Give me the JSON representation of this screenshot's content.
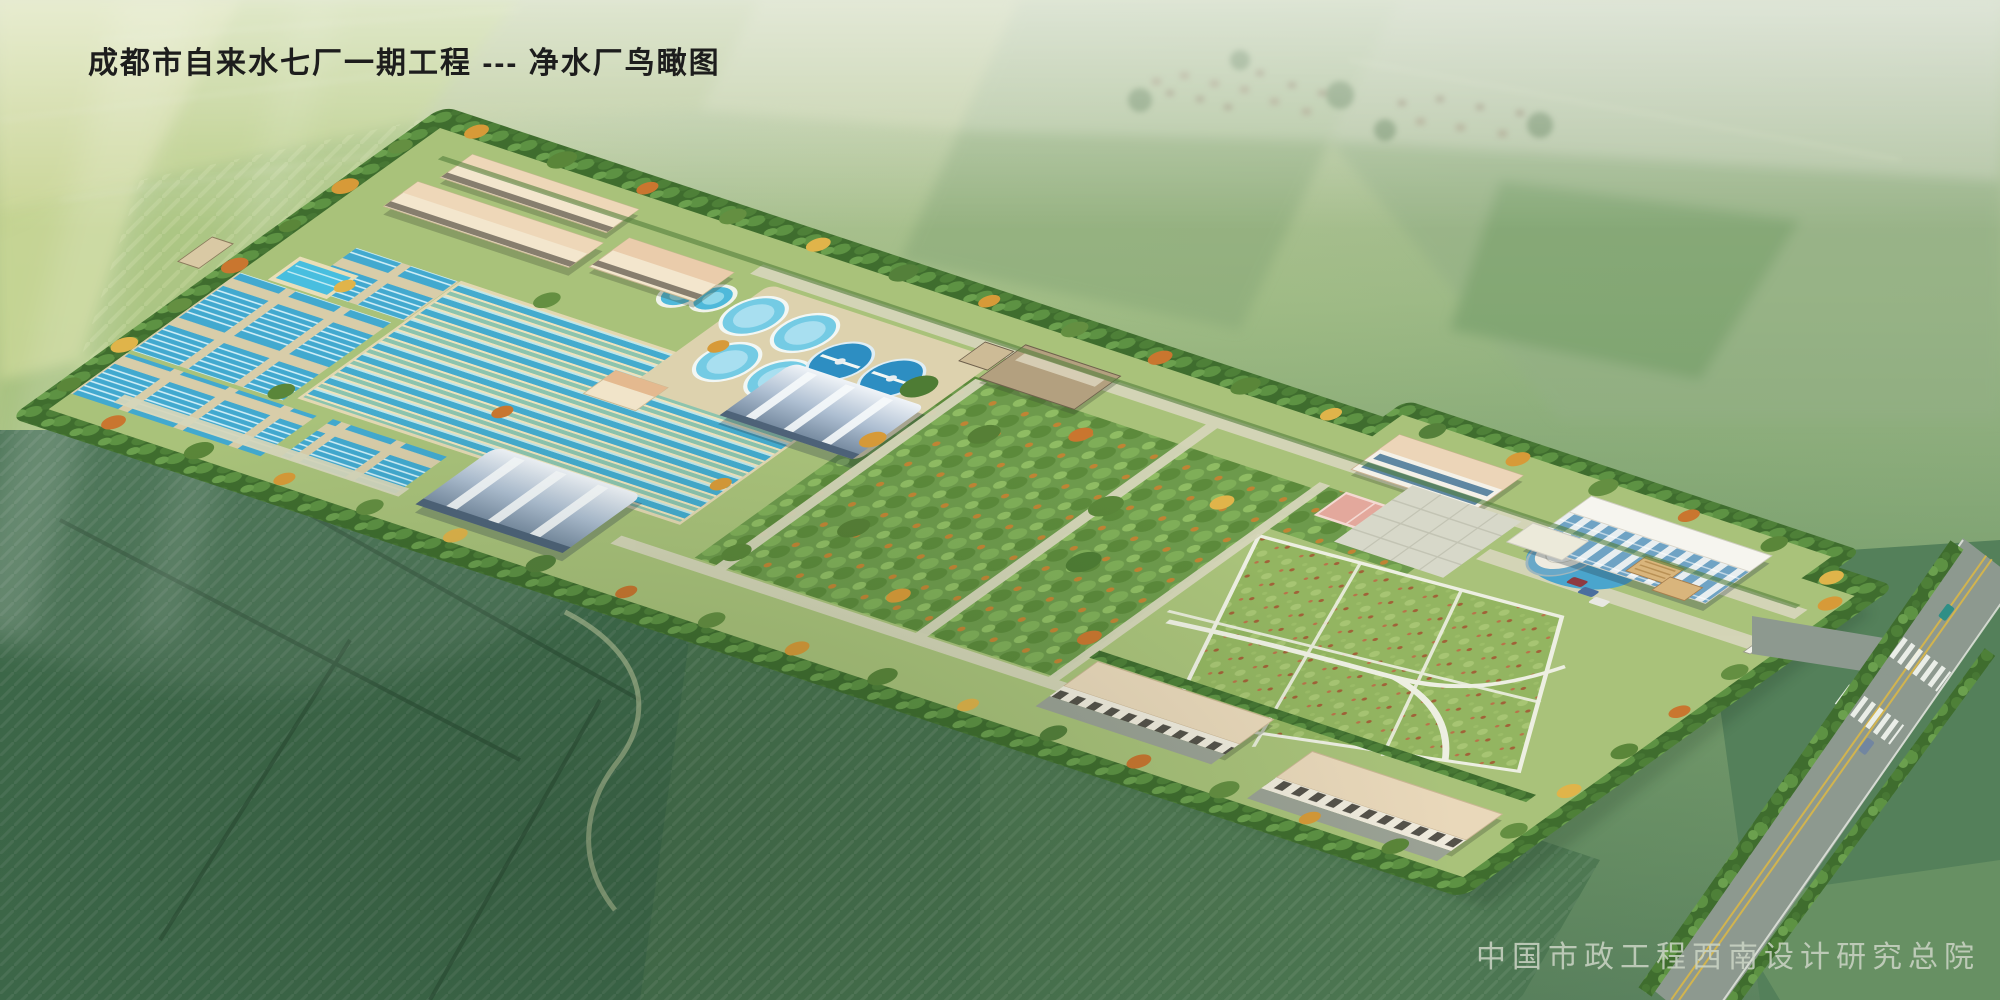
{
  "title": {
    "text": "成都市自来水七厂一期工程 --- 净水厂鸟瞰图"
  },
  "credit": {
    "text": "中国市政工程西南设计研究总院"
  },
  "scene": {
    "type": "architectural-birdseye-rendering",
    "clarifier_count": 8,
    "round_tank_count": 2,
    "arched_roof_building_count": 2,
    "palette": {
      "site_lawn": "#a9c27a",
      "pool_water": "#45aecf",
      "clarifier_dark": "#2d8ec2",
      "clarifier_light": "#74cbe4",
      "roof_beige": "#ecd5b8",
      "arch_roof_blue": "#9db1c6",
      "road_gray": "#8d998f",
      "road_line_yellow": "#d2b44e",
      "flower_lawn": "#93b561",
      "tree_dark": "#3f6d2e",
      "autumn_accent": "#d79a38",
      "title_text": "#1d1d1d",
      "credit_text": "#ccd5c6"
    }
  }
}
